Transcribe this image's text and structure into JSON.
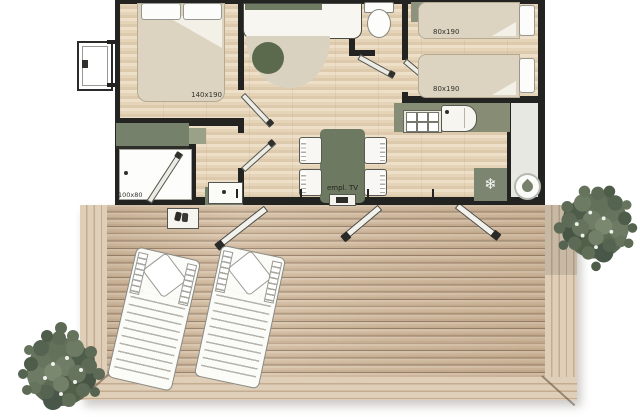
{
  "labels": {
    "double_bed": "140x190",
    "twin_bed_1": "80x190",
    "twin_bed_2": "80x190",
    "shower": "100x80",
    "tv_spot": "empl. TV"
  },
  "icons": {
    "fridge": {
      "name": "snowflake-icon",
      "glyph": "❄"
    },
    "water_heater": {
      "name": "water-drop-icon"
    }
  },
  "palette": {
    "wall": "#232321",
    "furniture_green": "#76816b",
    "table_green": "#6d7960",
    "interior_wood": "#e6d5bb",
    "deck_wood": "#d2bca1",
    "foliage_green": "#5d6b56",
    "fixture_white": "#fbfbf8"
  }
}
